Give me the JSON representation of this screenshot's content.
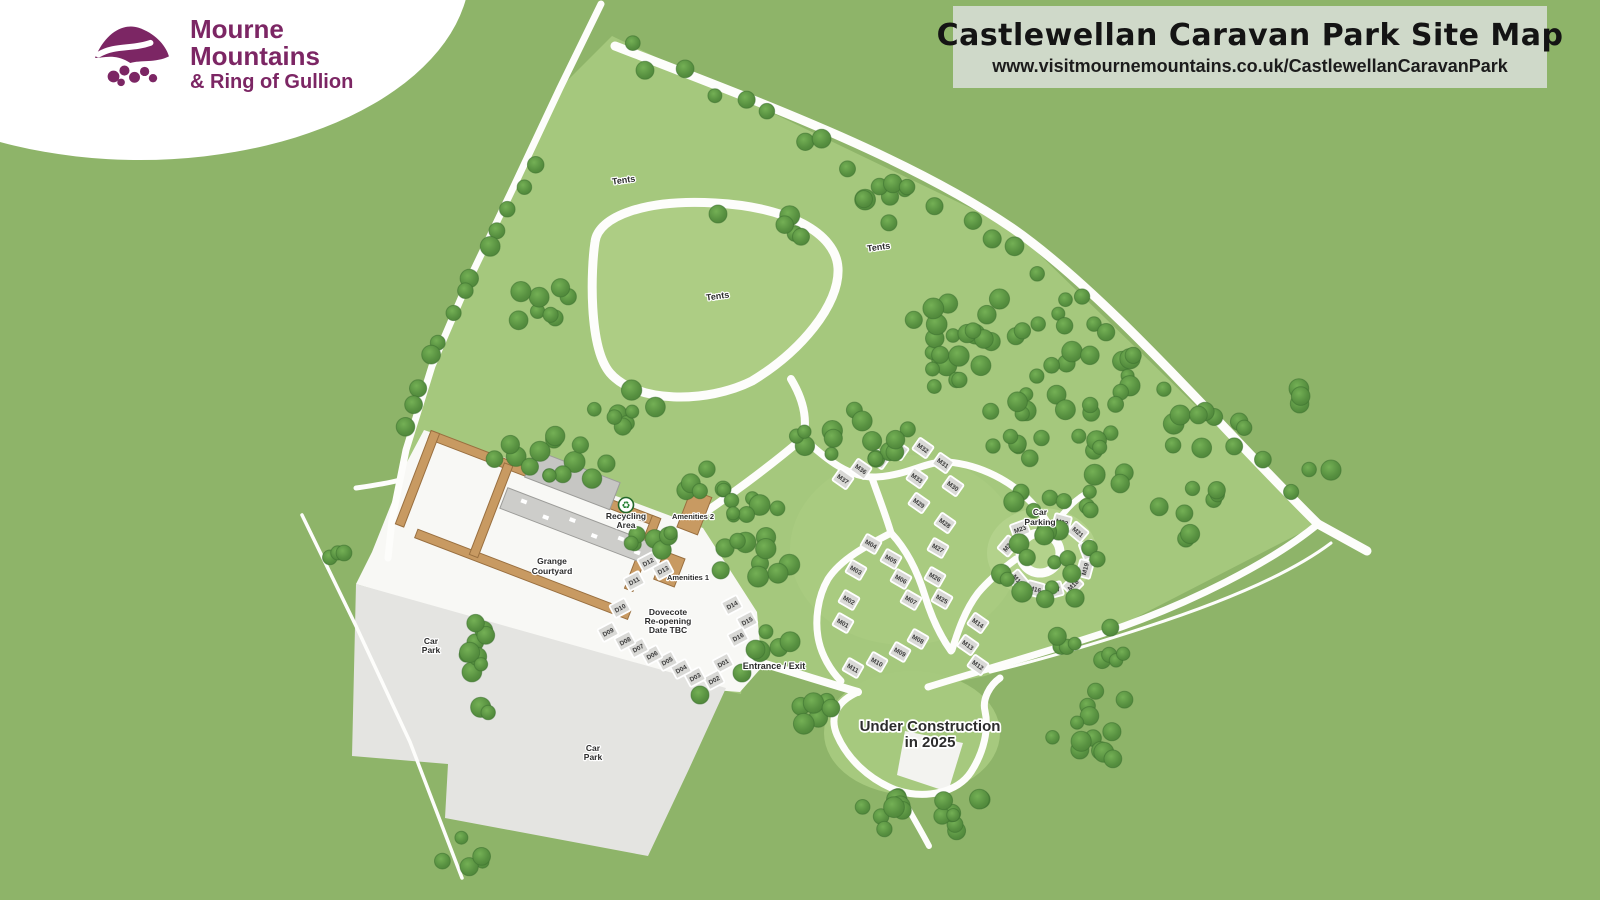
{
  "banner": {
    "title": "Castlewellan Caravan Park Site Map",
    "url": "www.visitmournemountains.co.uk/CastlewellanCaravanPark",
    "bg": "#cfd9c9"
  },
  "logo": {
    "line1": "Mourne",
    "line2": "Mountains",
    "line3": "& Ring of Gullion",
    "brand_purple": "#7c2664"
  },
  "map": {
    "colors": {
      "base_green": "#8eb469",
      "interior_green": "#a5c87d",
      "meadow_green": "#adcd84",
      "road_white": "#fdfdfb",
      "tree_dark": "#3d7130",
      "car_park_grey": "#e4e4e1",
      "pitch_grey": "#d9d9d6",
      "wall_tan": "#c89a62",
      "building_grey": "#c6c6c3",
      "label_ink": "#2c2c2c"
    },
    "areas": [
      {
        "name": "park-interior",
        "d": "M612 36 L1012 228 L1318 524 L1104 634 L985 676 L928 688 L858 694 L746 660 L741 694 L640 673 L356 584 L388 558 L406 450 L432 366 L468 282 L514 186 L560 88 Z",
        "fill": "#a5c87d"
      },
      {
        "name": "tents-meadow",
        "d": "M595 242 C598 216 646 199 715 203 C788 207 836 233 838 268 C840 305 800 352 752 381 C706 404 636 403 610 373 C588 347 591 268 595 242 Z",
        "fill": "#adcd84"
      },
      {
        "name": "m-pitch-zone",
        "type": "ellipse",
        "cx": 905,
        "cy": 550,
        "rx": 115,
        "ry": 95,
        "fill": "#a9cb80"
      },
      {
        "name": "circle-zone",
        "type": "ellipse",
        "cx": 1042,
        "cy": 553,
        "rx": 55,
        "ry": 45,
        "fill": "#b3d28b"
      },
      {
        "name": "construction-zone",
        "type": "ellipse",
        "cx": 912,
        "cy": 733,
        "rx": 88,
        "ry": 62,
        "fill": "#a6c97e"
      },
      {
        "name": "courtyard-ground",
        "d": "M424 430 L590 487 L636 503 L703 528 L757 612 L762 667 L740 692 L714 690 L356 584 L372 552 L392 502 L407 462 Z",
        "fill": "#f8f8f5"
      },
      {
        "name": "car-park-area",
        "d": "M356 584 L726 688 L689 769 L648 856 L445 818 L448 764 L352 756 Z",
        "fill": "#e4e4e1"
      },
      {
        "name": "under-construction-area",
        "d": "M905 731 L963 743 L948 792 L897 775 Z",
        "fill": "#f3f3f0"
      }
    ],
    "roads": [
      {
        "name": "left-boundary-path",
        "d": "M601 4 L560 88 L514 186 L468 282 L432 366 L406 450 L392 520 L388 558",
        "w": 7
      },
      {
        "name": "ne-boundary-path",
        "d": "M615 46 C760 102 910 158 1012 228 C1110 296 1232 440 1318 524",
        "w": 9
      },
      {
        "name": "east-exit-stub",
        "d": "M1318 524 L1367 551",
        "w": 9
      },
      {
        "name": "se-boundary-path",
        "d": "M1318 524 C1272 562 1190 604 1104 633 C1030 657 976 672 928 687",
        "w": 7
      },
      {
        "name": "se-trail",
        "d": "M1331 543 C1286 577 1214 605 1146 627 C1088 646 1032 662 990 672",
        "w": 3
      },
      {
        "name": "car-park-trail",
        "d": "M302 515 L356 626 L410 742 L462 878",
        "w": 3.5
      },
      {
        "name": "tents-loop-road",
        "d": "M595 242 C598 216 646 199 715 203 C788 207 836 233 838 268 C840 305 800 352 752 381 C706 404 636 403 610 373 C588 347 591 268 595 242 Z",
        "w": 9
      },
      {
        "name": "loop-connector",
        "d": "M791 379 C803 399 808 419 803 438",
        "w": 8
      },
      {
        "name": "west-service-road",
        "d": "M803 438 C768 468 724 500 692 521 C670 535 652 547 640 556",
        "w": 8
      },
      {
        "name": "upper-m-road",
        "d": "M803 438 C828 461 850 478 876 477 C910 475 925 461 948 462 C982 465 1012 482 1031 502 C1043 515 1048 522 1051 530",
        "w": 7
      },
      {
        "name": "ring-west-road",
        "d": "M1016 559 C1001 570 988 581 978 593 C965 610 958 631 952 650",
        "w": 7
      },
      {
        "name": "mid-branch-road",
        "d": "M872 478 C879 498 886 516 891 533",
        "w": 7
      },
      {
        "name": "mid-left-road",
        "d": "M891 533 C866 546 841 559 828 579 C818 596 814 621 819 642 C822 655 830 670 841 681",
        "w": 7
      },
      {
        "name": "mid-right-road",
        "d": "M891 533 C908 551 918 573 925 596 C932 619 941 637 951 651",
        "w": 7
      },
      {
        "name": "entrance-road",
        "d": "M748 659 C786 670 824 682 858 692",
        "w": 8
      },
      {
        "name": "construction-loop-road",
        "d": "M858 692 C840 700 828 714 837 735 C847 758 868 779 896 790 C926 800 958 792 971 772 C984 752 989 729 985 711 C982 699 990 685 1000 678",
        "w": 7
      },
      {
        "name": "construction-south-stub",
        "d": "M898 791 C909 810 920 829 929 846",
        "w": 6
      },
      {
        "name": "courtyard-west-stub",
        "d": "M400 480 C385 484 370 486 356 488",
        "w": 5
      },
      {
        "name": "ring-ne-path",
        "d": "M1052 529 C1062 514 1072 502 1085 494",
        "w": 6
      },
      {
        "name": "car-parking-ring",
        "type": "circle",
        "cx": 1040,
        "cy": 553,
        "r": 20,
        "w": 9
      }
    ],
    "pitches": [
      {
        "id": "D01",
        "x": 723,
        "y": 663,
        "rot": -28
      },
      {
        "id": "D02",
        "x": 714,
        "y": 680,
        "rot": -28
      },
      {
        "id": "D03",
        "x": 695,
        "y": 677,
        "rot": -28
      },
      {
        "id": "D04",
        "x": 681,
        "y": 669,
        "rot": -28
      },
      {
        "id": "D05",
        "x": 667,
        "y": 661,
        "rot": -28
      },
      {
        "id": "D06",
        "x": 652,
        "y": 655,
        "rot": -28
      },
      {
        "id": "D07",
        "x": 638,
        "y": 648,
        "rot": -28
      },
      {
        "id": "D08",
        "x": 625,
        "y": 641,
        "rot": -28
      },
      {
        "id": "D09",
        "x": 608,
        "y": 632,
        "rot": -28
      },
      {
        "id": "D10",
        "x": 620,
        "y": 608,
        "rot": -28
      },
      {
        "id": "D11",
        "x": 634,
        "y": 581,
        "rot": -28
      },
      {
        "id": "D12",
        "x": 648,
        "y": 562,
        "rot": -28
      },
      {
        "id": "D13",
        "x": 663,
        "y": 570,
        "rot": -28
      },
      {
        "id": "D14",
        "x": 732,
        "y": 605,
        "rot": -28
      },
      {
        "id": "D15",
        "x": 747,
        "y": 621,
        "rot": -28
      },
      {
        "id": "D16",
        "x": 738,
        "y": 637,
        "rot": -28
      },
      {
        "id": "M01",
        "x": 843,
        "y": 623,
        "rot": 30
      },
      {
        "id": "M02",
        "x": 849,
        "y": 600,
        "rot": 30
      },
      {
        "id": "M03",
        "x": 856,
        "y": 570,
        "rot": 30
      },
      {
        "id": "M04",
        "x": 871,
        "y": 544,
        "rot": 30
      },
      {
        "id": "M05",
        "x": 891,
        "y": 559,
        "rot": 30
      },
      {
        "id": "M06",
        "x": 901,
        "y": 579,
        "rot": 30
      },
      {
        "id": "M07",
        "x": 911,
        "y": 600,
        "rot": 30
      },
      {
        "id": "M08",
        "x": 918,
        "y": 639,
        "rot": 30
      },
      {
        "id": "M09",
        "x": 900,
        "y": 652,
        "rot": 30
      },
      {
        "id": "M10",
        "x": 877,
        "y": 662,
        "rot": 30
      },
      {
        "id": "M11",
        "x": 853,
        "y": 668,
        "rot": 30
      },
      {
        "id": "M12",
        "x": 978,
        "y": 665,
        "rot": 35
      },
      {
        "id": "M13",
        "x": 968,
        "y": 645,
        "rot": 35
      },
      {
        "id": "M14",
        "x": 978,
        "y": 623,
        "rot": 35
      },
      {
        "id": "M15",
        "x": 1018,
        "y": 580,
        "rot": 50
      },
      {
        "id": "M16",
        "x": 1035,
        "y": 589,
        "rot": 15
      },
      {
        "id": "M17",
        "x": 1054,
        "y": 590,
        "rot": -15
      },
      {
        "id": "M18",
        "x": 1073,
        "y": 585,
        "rot": -45
      },
      {
        "id": "M19",
        "x": 1085,
        "y": 569,
        "rot": -75
      },
      {
        "id": "M20",
        "x": 1088,
        "y": 550,
        "rot": 70
      },
      {
        "id": "M21",
        "x": 1078,
        "y": 532,
        "rot": 40
      },
      {
        "id": "M22",
        "x": 1062,
        "y": 522,
        "rot": 15
      },
      {
        "id": "M23",
        "x": 1020,
        "y": 529,
        "rot": -20
      },
      {
        "id": "M24",
        "x": 1008,
        "y": 546,
        "rot": -50
      },
      {
        "id": "M25",
        "x": 942,
        "y": 599,
        "rot": 30
      },
      {
        "id": "M26",
        "x": 935,
        "y": 577,
        "rot": 30
      },
      {
        "id": "M27",
        "x": 938,
        "y": 548,
        "rot": 30
      },
      {
        "id": "M28",
        "x": 945,
        "y": 523,
        "rot": 35
      },
      {
        "id": "M29",
        "x": 919,
        "y": 503,
        "rot": 35
      },
      {
        "id": "M30",
        "x": 953,
        "y": 486,
        "rot": 35
      },
      {
        "id": "M31",
        "x": 943,
        "y": 463,
        "rot": 35
      },
      {
        "id": "M32",
        "x": 923,
        "y": 448,
        "rot": 35
      },
      {
        "id": "M33",
        "x": 917,
        "y": 478,
        "rot": 35
      },
      {
        "id": "M34",
        "x": 898,
        "y": 450,
        "rot": 35
      },
      {
        "id": "M35",
        "x": 879,
        "y": 459,
        "rot": 35
      },
      {
        "id": "M36",
        "x": 861,
        "y": 469,
        "rot": 35
      },
      {
        "id": "M37",
        "x": 843,
        "y": 479,
        "rot": 35
      }
    ],
    "labels": [
      {
        "name": "label-tents-1",
        "lines": [
          "Tents"
        ],
        "x": 624,
        "y": 183,
        "size": 9,
        "rot": -8
      },
      {
        "name": "label-tents-2",
        "lines": [
          "Tents"
        ],
        "x": 879,
        "y": 250,
        "size": 9,
        "rot": -8
      },
      {
        "name": "label-tents-3",
        "lines": [
          "Tents"
        ],
        "x": 718,
        "y": 299,
        "size": 9,
        "rot": -8
      },
      {
        "name": "label-recycling-area",
        "lines": [
          "Recycling",
          "Area"
        ],
        "x": 626,
        "y": 519,
        "size": 8.5,
        "lh": 9
      },
      {
        "name": "label-amenities-2",
        "lines": [
          "Amenities 2"
        ],
        "x": 693,
        "y": 519,
        "size": 7.5
      },
      {
        "name": "label-amenities-1",
        "lines": [
          "Amenities 1"
        ],
        "x": 688,
        "y": 580,
        "size": 7.5
      },
      {
        "name": "label-grange-courtyard",
        "lines": [
          "Grange",
          "Courtyard"
        ],
        "x": 552,
        "y": 564,
        "size": 8.5,
        "lh": 10
      },
      {
        "name": "label-dovecote",
        "lines": [
          "Dovecote",
          "Re-opening",
          "Date TBC"
        ],
        "x": 668,
        "y": 615,
        "size": 8.5,
        "lh": 9
      },
      {
        "name": "label-car-park-west",
        "lines": [
          "Car",
          "Park"
        ],
        "x": 431,
        "y": 644,
        "size": 8.5,
        "lh": 9
      },
      {
        "name": "label-car-park-south",
        "lines": [
          "Car",
          "Park"
        ],
        "x": 593,
        "y": 751,
        "size": 8.5,
        "lh": 9
      },
      {
        "name": "label-car-parking",
        "lines": [
          "Car",
          "Parking"
        ],
        "x": 1040,
        "y": 515,
        "size": 8.5,
        "lh": 10
      },
      {
        "name": "label-entrance-exit",
        "lines": [
          "Entrance / Exit"
        ],
        "x": 774,
        "y": 669,
        "size": 9,
        "weight": 800
      },
      {
        "name": "label-under-construction",
        "lines": [
          "Under Construction",
          "in 2025"
        ],
        "x": 930,
        "y": 731,
        "size": 15,
        "lh": 16,
        "weight": 800
      }
    ],
    "poi": {
      "recycling_icon": {
        "x": 626,
        "y": 505,
        "glyph": "♻"
      }
    },
    "tree_blobs": [
      [
        1040,
        360,
        120,
        65,
        40
      ],
      [
        1060,
        470,
        75,
        55,
        22
      ],
      [
        1055,
        572,
        58,
        42,
        16
      ],
      [
        1090,
        640,
        45,
        26,
        9
      ],
      [
        948,
        328,
        40,
        30,
        10
      ],
      [
        1205,
        430,
        45,
        25,
        8
      ],
      [
        1195,
        512,
        40,
        28,
        8
      ],
      [
        545,
        312,
        36,
        30,
        8
      ],
      [
        625,
        408,
        40,
        22,
        8
      ],
      [
        860,
        435,
        65,
        28,
        15
      ],
      [
        550,
        457,
        78,
        26,
        14
      ],
      [
        655,
        540,
        28,
        18,
        7
      ],
      [
        752,
        568,
        38,
        34,
        11
      ],
      [
        772,
        640,
        22,
        20,
        6
      ],
      [
        481,
        665,
        15,
        55,
        11
      ],
      [
        462,
        852,
        26,
        18,
        6
      ],
      [
        815,
        712,
        26,
        17,
        6
      ],
      [
        880,
        808,
        28,
        22,
        8
      ],
      [
        963,
        810,
        28,
        22,
        8
      ],
      [
        1095,
        730,
        48,
        40,
        13
      ],
      [
        885,
        202,
        26,
        22,
        6
      ],
      [
        800,
        226,
        18,
        14,
        4
      ],
      [
        340,
        552,
        12,
        10,
        3
      ],
      [
        705,
        480,
        26,
        15,
        6
      ],
      [
        752,
        512,
        30,
        18,
        7
      ],
      [
        1295,
        400,
        15,
        12,
        3
      ],
      [
        1320,
        470,
        12,
        10,
        2
      ]
    ],
    "tree_lines": [
      [
        625,
        48,
        1000,
        232,
        14,
        9
      ],
      [
        1012,
        248,
        1288,
        494,
        10,
        10
      ],
      [
        528,
        158,
        404,
        430,
        13,
        8
      ]
    ],
    "tree_singles": [
      [
        718,
        214
      ],
      [
        742,
        673
      ],
      [
        700,
        695
      ]
    ]
  }
}
